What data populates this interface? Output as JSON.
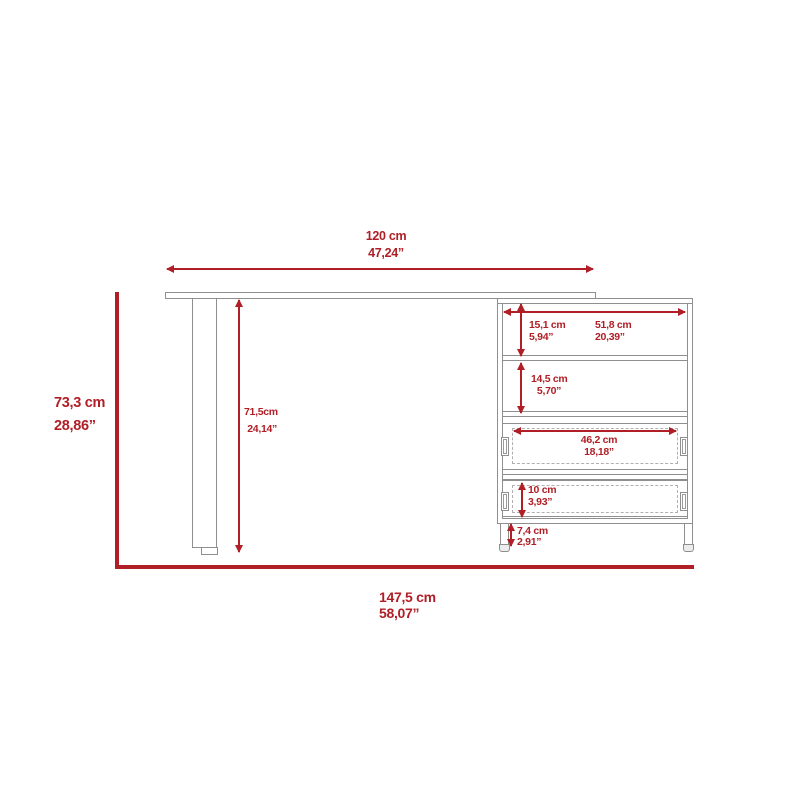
{
  "colors": {
    "dimension_red": "#b01e26",
    "outline_gray": "#8f8f8f"
  },
  "labels": {
    "desk_top_width": {
      "cm": "120 cm",
      "in": "47,24”"
    },
    "overall_height": {
      "cm": "73,3 cm",
      "in": "28,86”"
    },
    "leg_height": {
      "cm": "71,5cm",
      "in": "24,14”"
    },
    "top_shelf_height": {
      "cm": "15,1 cm",
      "in": "5,94”"
    },
    "shelf_width": {
      "cm": "51,8 cm",
      "in": "20,39”"
    },
    "middle_shelf_height": {
      "cm": "14,5 cm",
      "in": "5,70”"
    },
    "drawer_width": {
      "cm": "46,2 cm",
      "in": "18,18”"
    },
    "drawer_height": {
      "cm": "10 cm",
      "in": "3,93”"
    },
    "foot_height": {
      "cm": "7,4 cm",
      "in": "2,91”"
    },
    "overall_width": {
      "cm": "147,5 cm",
      "in": "58,07”"
    }
  }
}
